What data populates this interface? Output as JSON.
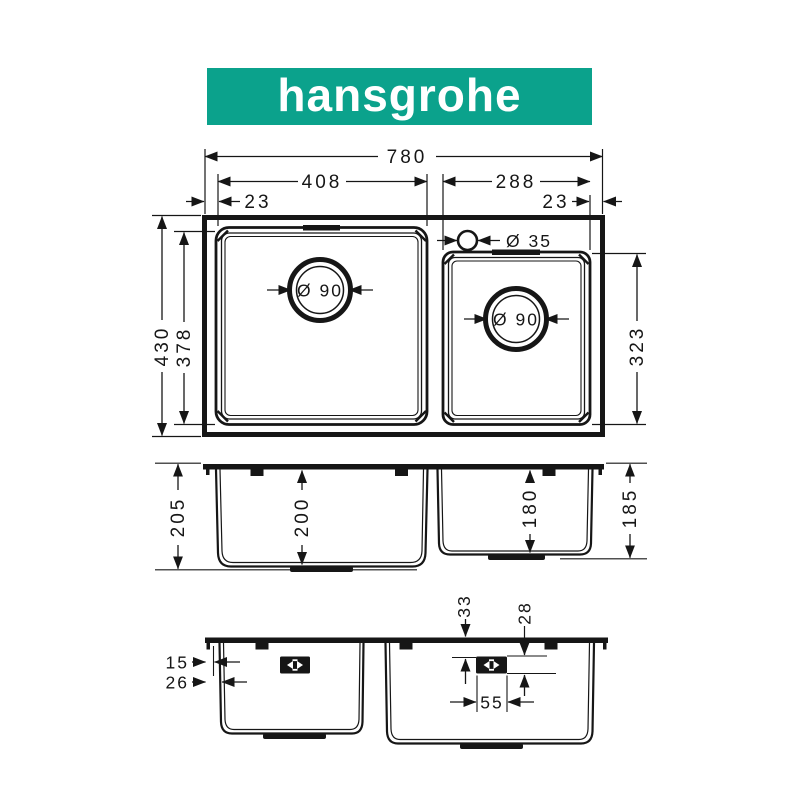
{
  "brand": {
    "logo_text": "hansgrohe",
    "logo_bg": "#0ba28c",
    "logo_fg": "#ffffff"
  },
  "drawing": {
    "ink": "#161616",
    "top_view": {
      "overall_width": "780",
      "left_bowl_width": "408",
      "right_bowl_width": "288",
      "left_edge_gap": "23",
      "right_edge_gap": "23",
      "tap_hole_diameter": "Ø 35",
      "left_drain_diameter": "Ø 90",
      "right_drain_diameter": "Ø 90",
      "overall_depth": "430",
      "left_bowl_depth": "378",
      "right_bowl_depth": "323"
    },
    "front_view": {
      "left_outer_height": "205",
      "left_bowl_height": "200",
      "right_bowl_height": "180",
      "right_outer_height": "185"
    },
    "back_view": {
      "rim_lip": "15",
      "wall_inset": "26",
      "overflow_top_gap": "33",
      "overflow_drop": "28",
      "overflow_width": "55"
    }
  }
}
